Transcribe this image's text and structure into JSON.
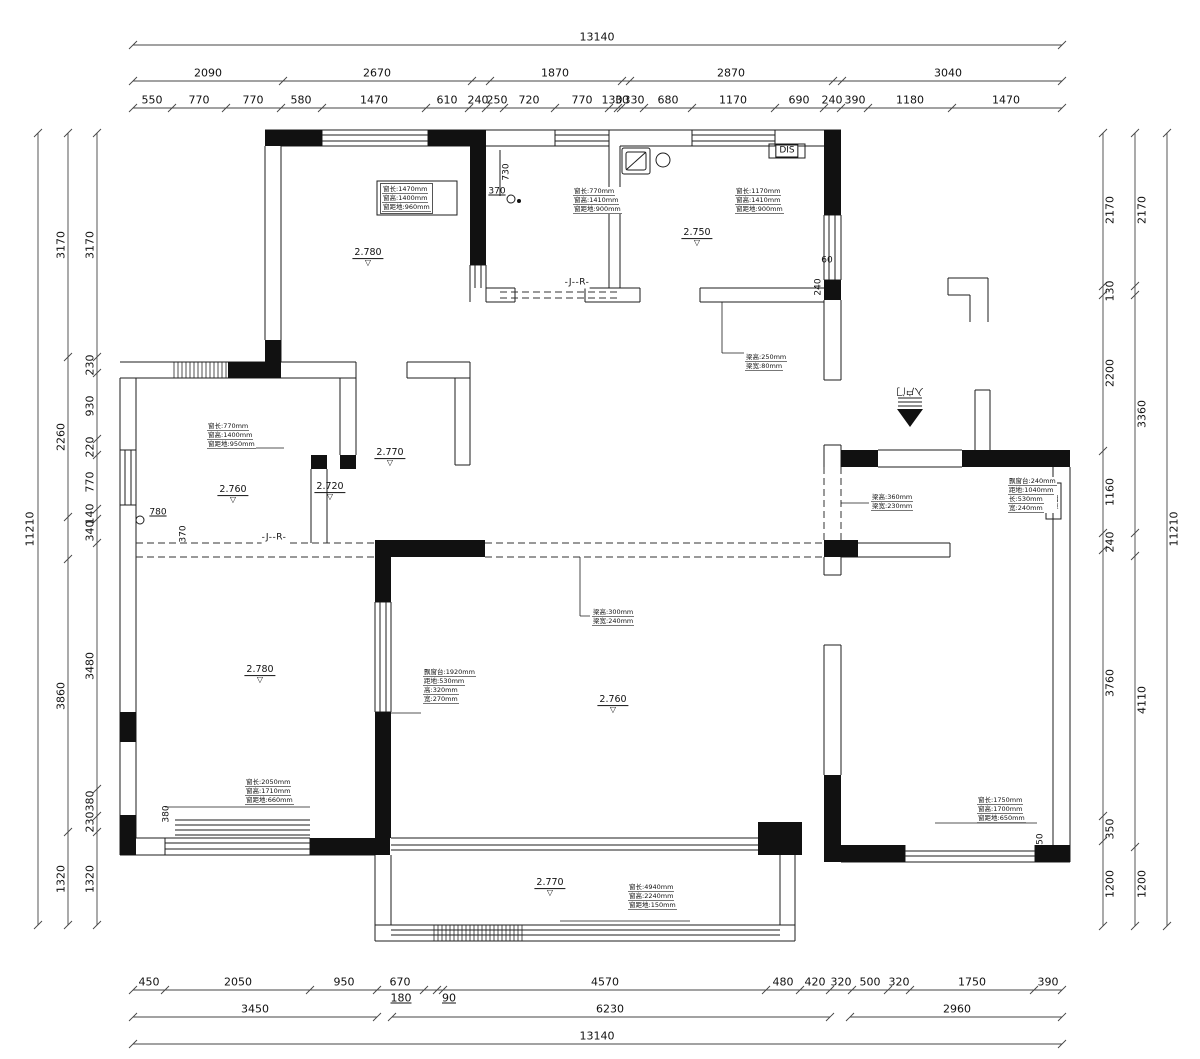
{
  "drawing": {
    "background": "#ffffff",
    "line_color": "#1d1d1d",
    "dim_color": "#333333"
  },
  "duct": {
    "t": "烟道"
  },
  "dimensions": {
    "lines": [
      [
        133,
        45,
        1062,
        45
      ],
      [
        133,
        81,
        1062,
        81
      ],
      [
        133,
        108,
        1062,
        108
      ],
      [
        133,
        990,
        1062,
        990
      ],
      [
        133,
        1017,
        377,
        1017
      ],
      [
        392,
        1017,
        830,
        1017
      ],
      [
        850,
        1017,
        1062,
        1017
      ],
      [
        133,
        1044,
        1062,
        1044
      ],
      [
        38,
        133,
        38,
        925
      ],
      [
        68,
        133,
        68,
        925
      ],
      [
        97,
        133,
        97,
        925
      ],
      [
        1103,
        133,
        1103,
        926
      ],
      [
        1135,
        133,
        1135,
        926
      ],
      [
        1167,
        133,
        1167,
        926
      ]
    ],
    "tick_rows": [
      {
        "y": 45,
        "xs": [
          133,
          1062
        ]
      },
      {
        "y": 81,
        "xs": [
          133,
          283,
          472,
          490,
          622,
          630,
          833,
          842,
          1062
        ]
      },
      {
        "y": 108,
        "xs": [
          133,
          172,
          226,
          281,
          322,
          426,
          469,
          486,
          504,
          555,
          609,
          618,
          621,
          644,
          692,
          775,
          824,
          841,
          868,
          952,
          1062
        ]
      },
      {
        "y": 990,
        "xs": [
          133,
          165,
          310,
          377,
          424,
          437,
          443,
          766,
          800,
          830,
          852,
          888,
          910,
          1034,
          1062
        ]
      },
      {
        "y": 1017,
        "xs": [
          133,
          377,
          392,
          830,
          850,
          1062
        ]
      },
      {
        "y": 1044,
        "xs": [
          133,
          1062
        ]
      },
      {
        "x": 38,
        "ys": [
          133,
          925
        ]
      },
      {
        "x": 68,
        "ys": [
          133,
          357,
          517,
          559,
          832,
          925
        ]
      },
      {
        "x": 97,
        "ys": [
          133,
          357,
          373,
          439,
          455,
          509,
          519,
          543,
          789,
          816,
          832,
          925
        ]
      },
      {
        "x": 1103,
        "ys": [
          133,
          286,
          295,
          451,
          533,
          550,
          816,
          841,
          926
        ]
      },
      {
        "x": 1135,
        "ys": [
          133,
          286,
          295,
          533,
          556,
          847,
          926
        ]
      },
      {
        "x": 1167,
        "ys": [
          133,
          926
        ]
      }
    ]
  },
  "labels": [
    {
      "t": "13140",
      "x": 597,
      "y": 37
    },
    {
      "t": "2090",
      "x": 208,
      "y": 73
    },
    {
      "t": "2670",
      "x": 377,
      "y": 73
    },
    {
      "t": "1870",
      "x": 555,
      "y": 73
    },
    {
      "t": "2870",
      "x": 731,
      "y": 73
    },
    {
      "t": "3040",
      "x": 948,
      "y": 73
    },
    {
      "t": "550",
      "x": 152,
      "y": 100
    },
    {
      "t": "770",
      "x": 199,
      "y": 100
    },
    {
      "t": "770",
      "x": 253,
      "y": 100
    },
    {
      "t": "580",
      "x": 301,
      "y": 100
    },
    {
      "t": "1470",
      "x": 374,
      "y": 100
    },
    {
      "t": "610",
      "x": 447,
      "y": 100
    },
    {
      "t": "240",
      "x": 478,
      "y": 100
    },
    {
      "t": "250",
      "x": 497,
      "y": 100
    },
    {
      "t": "720",
      "x": 529,
      "y": 100
    },
    {
      "t": "770",
      "x": 582,
      "y": 100
    },
    {
      "t": "130",
      "x": 612,
      "y": 100
    },
    {
      "t": "30",
      "x": 622,
      "y": 100
    },
    {
      "t": "330",
      "x": 634,
      "y": 100
    },
    {
      "t": "680",
      "x": 668,
      "y": 100
    },
    {
      "t": "1170",
      "x": 733,
      "y": 100
    },
    {
      "t": "690",
      "x": 799,
      "y": 100
    },
    {
      "t": "240",
      "x": 832,
      "y": 100
    },
    {
      "t": "390",
      "x": 855,
      "y": 100
    },
    {
      "t": "1180",
      "x": 910,
      "y": 100
    },
    {
      "t": "1470",
      "x": 1006,
      "y": 100
    },
    {
      "t": "450",
      "x": 149,
      "y": 982
    },
    {
      "t": "2050",
      "x": 238,
      "y": 982
    },
    {
      "t": "950",
      "x": 344,
      "y": 982
    },
    {
      "t": "670",
      "x": 400,
      "y": 982
    },
    {
      "t": "4570",
      "x": 605,
      "y": 982
    },
    {
      "t": "480",
      "x": 783,
      "y": 982
    },
    {
      "t": "420",
      "x": 815,
      "y": 982
    },
    {
      "t": "320",
      "x": 841,
      "y": 982
    },
    {
      "t": "500",
      "x": 870,
      "y": 982
    },
    {
      "t": "320",
      "x": 899,
      "y": 982
    },
    {
      "t": "1750",
      "x": 972,
      "y": 982
    },
    {
      "t": "390",
      "x": 1048,
      "y": 982
    },
    {
      "t": "180",
      "x": 401,
      "y": 998,
      "u": 1
    },
    {
      "t": "90",
      "x": 449,
      "y": 998,
      "u": 1
    },
    {
      "t": "3450",
      "x": 255,
      "y": 1009
    },
    {
      "t": "6230",
      "x": 610,
      "y": 1009
    },
    {
      "t": "2960",
      "x": 957,
      "y": 1009
    },
    {
      "t": "13140",
      "x": 597,
      "y": 1036
    },
    {
      "t": "11210",
      "x": 30,
      "y": 529,
      "r": -90
    },
    {
      "t": "3170",
      "x": 61,
      "y": 245,
      "r": -90
    },
    {
      "t": "2260",
      "x": 61,
      "y": 437,
      "r": -90
    },
    {
      "t": "3860",
      "x": 61,
      "y": 696,
      "r": -90
    },
    {
      "t": "1320",
      "x": 61,
      "y": 879,
      "r": -90
    },
    {
      "t": "3170",
      "x": 90,
      "y": 245,
      "r": -90
    },
    {
      "t": "230",
      "x": 90,
      "y": 365,
      "r": -90
    },
    {
      "t": "930",
      "x": 90,
      "y": 406,
      "r": -90
    },
    {
      "t": "220",
      "x": 90,
      "y": 447,
      "r": -90
    },
    {
      "t": "770",
      "x": 90,
      "y": 482,
      "r": -90
    },
    {
      "t": "140",
      "x": 90,
      "y": 514,
      "r": -90
    },
    {
      "t": "340",
      "x": 90,
      "y": 531,
      "r": -90
    },
    {
      "t": "3480",
      "x": 90,
      "y": 666,
      "r": -90
    },
    {
      "t": "380",
      "x": 90,
      "y": 801,
      "r": -90
    },
    {
      "t": "230",
      "x": 90,
      "y": 822,
      "r": -90
    },
    {
      "t": "1320",
      "x": 90,
      "y": 879,
      "r": -90
    },
    {
      "t": "2170",
      "x": 1110,
      "y": 210,
      "r": -90
    },
    {
      "t": "130",
      "x": 1110,
      "y": 291,
      "r": -90
    },
    {
      "t": "2200",
      "x": 1110,
      "y": 373,
      "r": -90
    },
    {
      "t": "1160",
      "x": 1110,
      "y": 492,
      "r": -90
    },
    {
      "t": "240",
      "x": 1110,
      "y": 542,
      "r": -90
    },
    {
      "t": "3760",
      "x": 1110,
      "y": 683,
      "r": -90
    },
    {
      "t": "350",
      "x": 1110,
      "y": 829,
      "r": -90
    },
    {
      "t": "1200",
      "x": 1110,
      "y": 884,
      "r": -90
    },
    {
      "t": "2170",
      "x": 1142,
      "y": 210,
      "r": -90
    },
    {
      "t": "3360",
      "x": 1142,
      "y": 414,
      "r": -90
    },
    {
      "t": "4110",
      "x": 1142,
      "y": 700,
      "r": -90
    },
    {
      "t": "1200",
      "x": 1142,
      "y": 884,
      "r": -90
    },
    {
      "t": "11210",
      "x": 1174,
      "y": 529,
      "r": -90
    },
    {
      "t": "730",
      "x": 507,
      "y": 172,
      "r": -90,
      "cls": "sm"
    },
    {
      "t": "370",
      "x": 497,
      "y": 192,
      "u": 1,
      "cls": "sm"
    },
    {
      "t": "780",
      "x": 158,
      "y": 513,
      "u": 1,
      "cls": "sm"
    },
    {
      "t": "370",
      "x": 184,
      "y": 534,
      "r": -90,
      "cls": "sm"
    },
    {
      "t": "380",
      "x": 167,
      "y": 814,
      "r": -90,
      "cls": "sm"
    },
    {
      "t": "350",
      "x": 1041,
      "y": 842,
      "r": -90,
      "cls": "sm"
    },
    {
      "t": "60",
      "x": 827,
      "y": 261,
      "cls": "sm"
    },
    {
      "t": "240",
      "x": 819,
      "y": 287,
      "r": -90,
      "cls": "sm"
    },
    {
      "t": "DIS",
      "x": 787,
      "y": 151,
      "cls": "dis"
    },
    {
      "t": "-J--R-",
      "x": 577,
      "y": 283,
      "cls": "jr"
    },
    {
      "t": "-J--R-",
      "x": 274,
      "y": 538,
      "cls": "jr"
    },
    {
      "t": "入户门",
      "x": 910,
      "y": 390,
      "r": 180,
      "cls": "entry"
    }
  ],
  "levels": [
    {
      "t": "2.780",
      "x": 368,
      "y": 258
    },
    {
      "t": "2.750",
      "x": 697,
      "y": 238
    },
    {
      "t": "2.770",
      "x": 390,
      "y": 458
    },
    {
      "t": "2.760",
      "x": 233,
      "y": 495
    },
    {
      "t": "2.720",
      "x": 330,
      "y": 492
    },
    {
      "t": "2.780",
      "x": 260,
      "y": 675
    },
    {
      "t": "2.760",
      "x": 613,
      "y": 705
    },
    {
      "t": "2.770",
      "x": 550,
      "y": 888
    }
  ],
  "annotations": [
    {
      "x": 380,
      "y": 183,
      "box": 1,
      "lines": [
        "窗长:1470mm",
        "窗高:1400mm",
        "窗距地:960mm"
      ]
    },
    {
      "x": 573,
      "y": 187,
      "lines": [
        "窗长:770mm",
        "窗高:1410mm",
        "窗距地:900mm"
      ]
    },
    {
      "x": 735,
      "y": 187,
      "lines": [
        "窗长:1170mm",
        "窗高:1410mm",
        "窗距地:900mm"
      ]
    },
    {
      "x": 207,
      "y": 422,
      "lines": [
        "窗长:770mm",
        "窗高:1400mm",
        "窗距地:950mm"
      ]
    },
    {
      "x": 745,
      "y": 353,
      "lines": [
        "梁高:250mm",
        "梁宽:80mm"
      ]
    },
    {
      "x": 871,
      "y": 493,
      "lines": [
        "梁高:360mm",
        "梁宽:230mm"
      ]
    },
    {
      "x": 1008,
      "y": 477,
      "lines": [
        "飘窗台:240mm",
        "距地:1040mm",
        "长:530mm",
        "宽:240mm"
      ]
    },
    {
      "x": 592,
      "y": 608,
      "lines": [
        "梁高:300mm",
        "梁宽:240mm"
      ]
    },
    {
      "x": 423,
      "y": 668,
      "lines": [
        "飘窗台:1920mm",
        "距地:530mm",
        "高:320mm",
        "宽:270mm"
      ]
    },
    {
      "x": 245,
      "y": 778,
      "lines": [
        "窗长:2050mm",
        "窗高:1710mm",
        "窗距地:660mm"
      ]
    },
    {
      "x": 977,
      "y": 796,
      "lines": [
        "窗长:1750mm",
        "窗高:1700mm",
        "窗距地:650mm"
      ]
    },
    {
      "x": 628,
      "y": 883,
      "lines": [
        "窗长:4940mm",
        "窗高:2240mm",
        "窗距地:150mm"
      ]
    }
  ]
}
